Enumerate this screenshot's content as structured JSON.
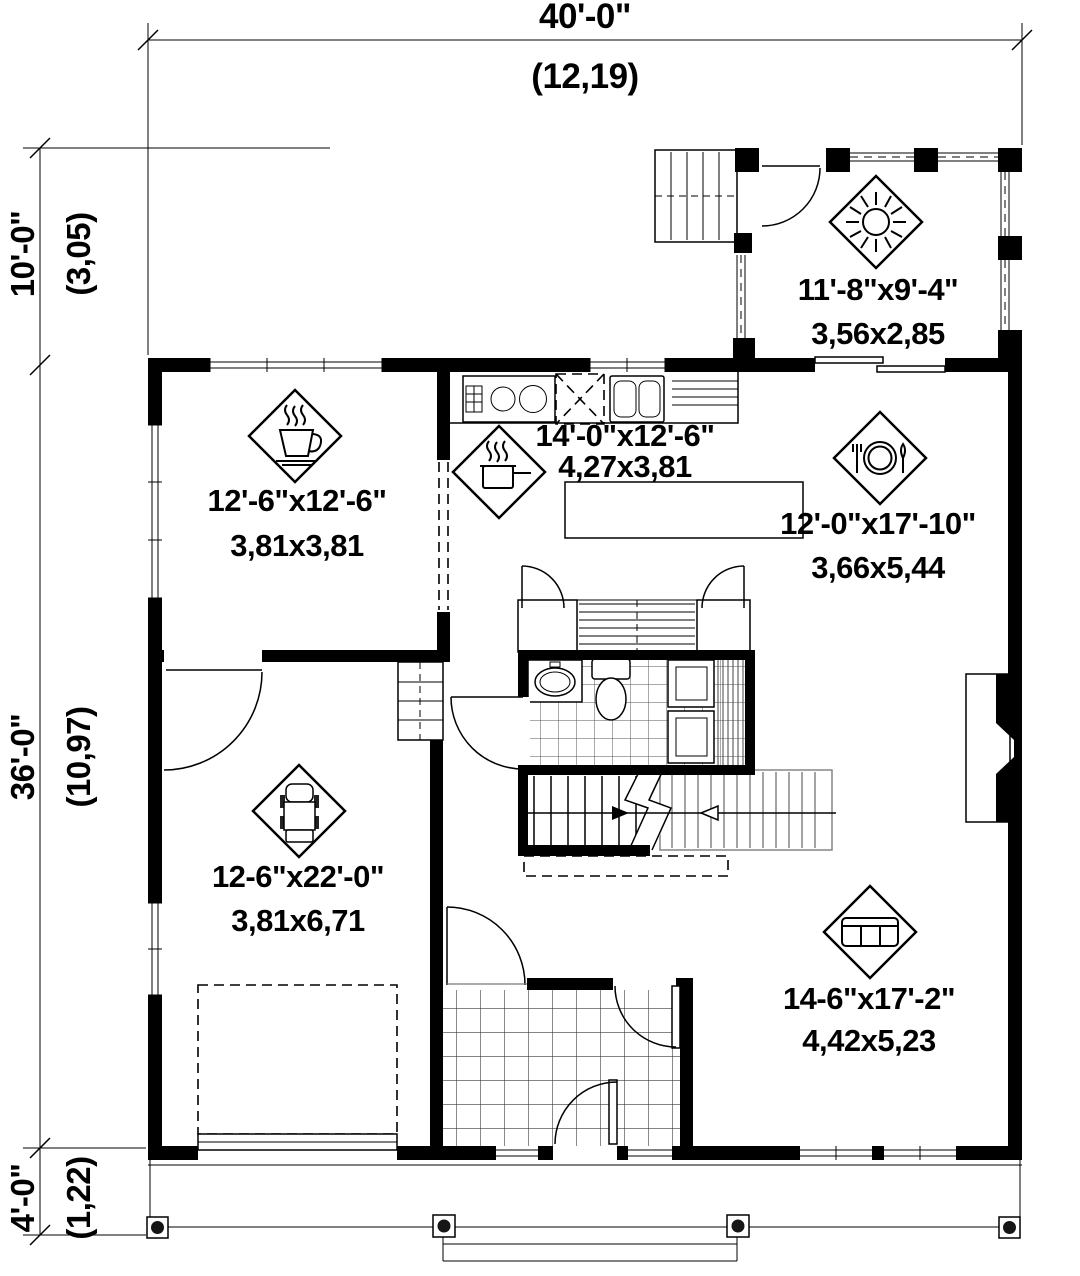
{
  "page": {
    "background": "#ffffff",
    "ink": "#000000",
    "stair_gray": "#868686"
  },
  "dimensions": {
    "top": {
      "imperial": "40'-0\"",
      "metric": "(12,19)"
    },
    "left_upper": {
      "imperial": "10'-0\"",
      "metric": "(3,05)"
    },
    "left_middle": {
      "imperial": "36'-0\"",
      "metric": "(10,97)"
    },
    "left_lower": {
      "imperial": "4'-0\"",
      "metric": "(1,22)"
    }
  },
  "rooms": {
    "deck": {
      "imperial": "11'-8\"x9'-4\"",
      "metric": "3,56x2,85",
      "icon": "sun-icon"
    },
    "breakfast": {
      "imperial": "12'-6\"x12'-6\"",
      "metric": "3,81x3,81",
      "icon": "coffee-cup-icon"
    },
    "kitchen": {
      "imperial": "14'-0\"x12'-6\"",
      "metric": "4,27x3,81",
      "icon": "cooking-pot-icon"
    },
    "dining": {
      "imperial": "12'-0\"x17'-10\"",
      "metric": "3,66x5,44",
      "icon": "plate-cutlery-icon"
    },
    "garage": {
      "imperial": "12-6\"x22'-0\"",
      "metric": "3,81x6,71",
      "icon": "car-icon"
    },
    "living": {
      "imperial": "14-6\"x17'-2\"",
      "metric": "4,42x5,23",
      "icon": "sofa-icon"
    }
  }
}
